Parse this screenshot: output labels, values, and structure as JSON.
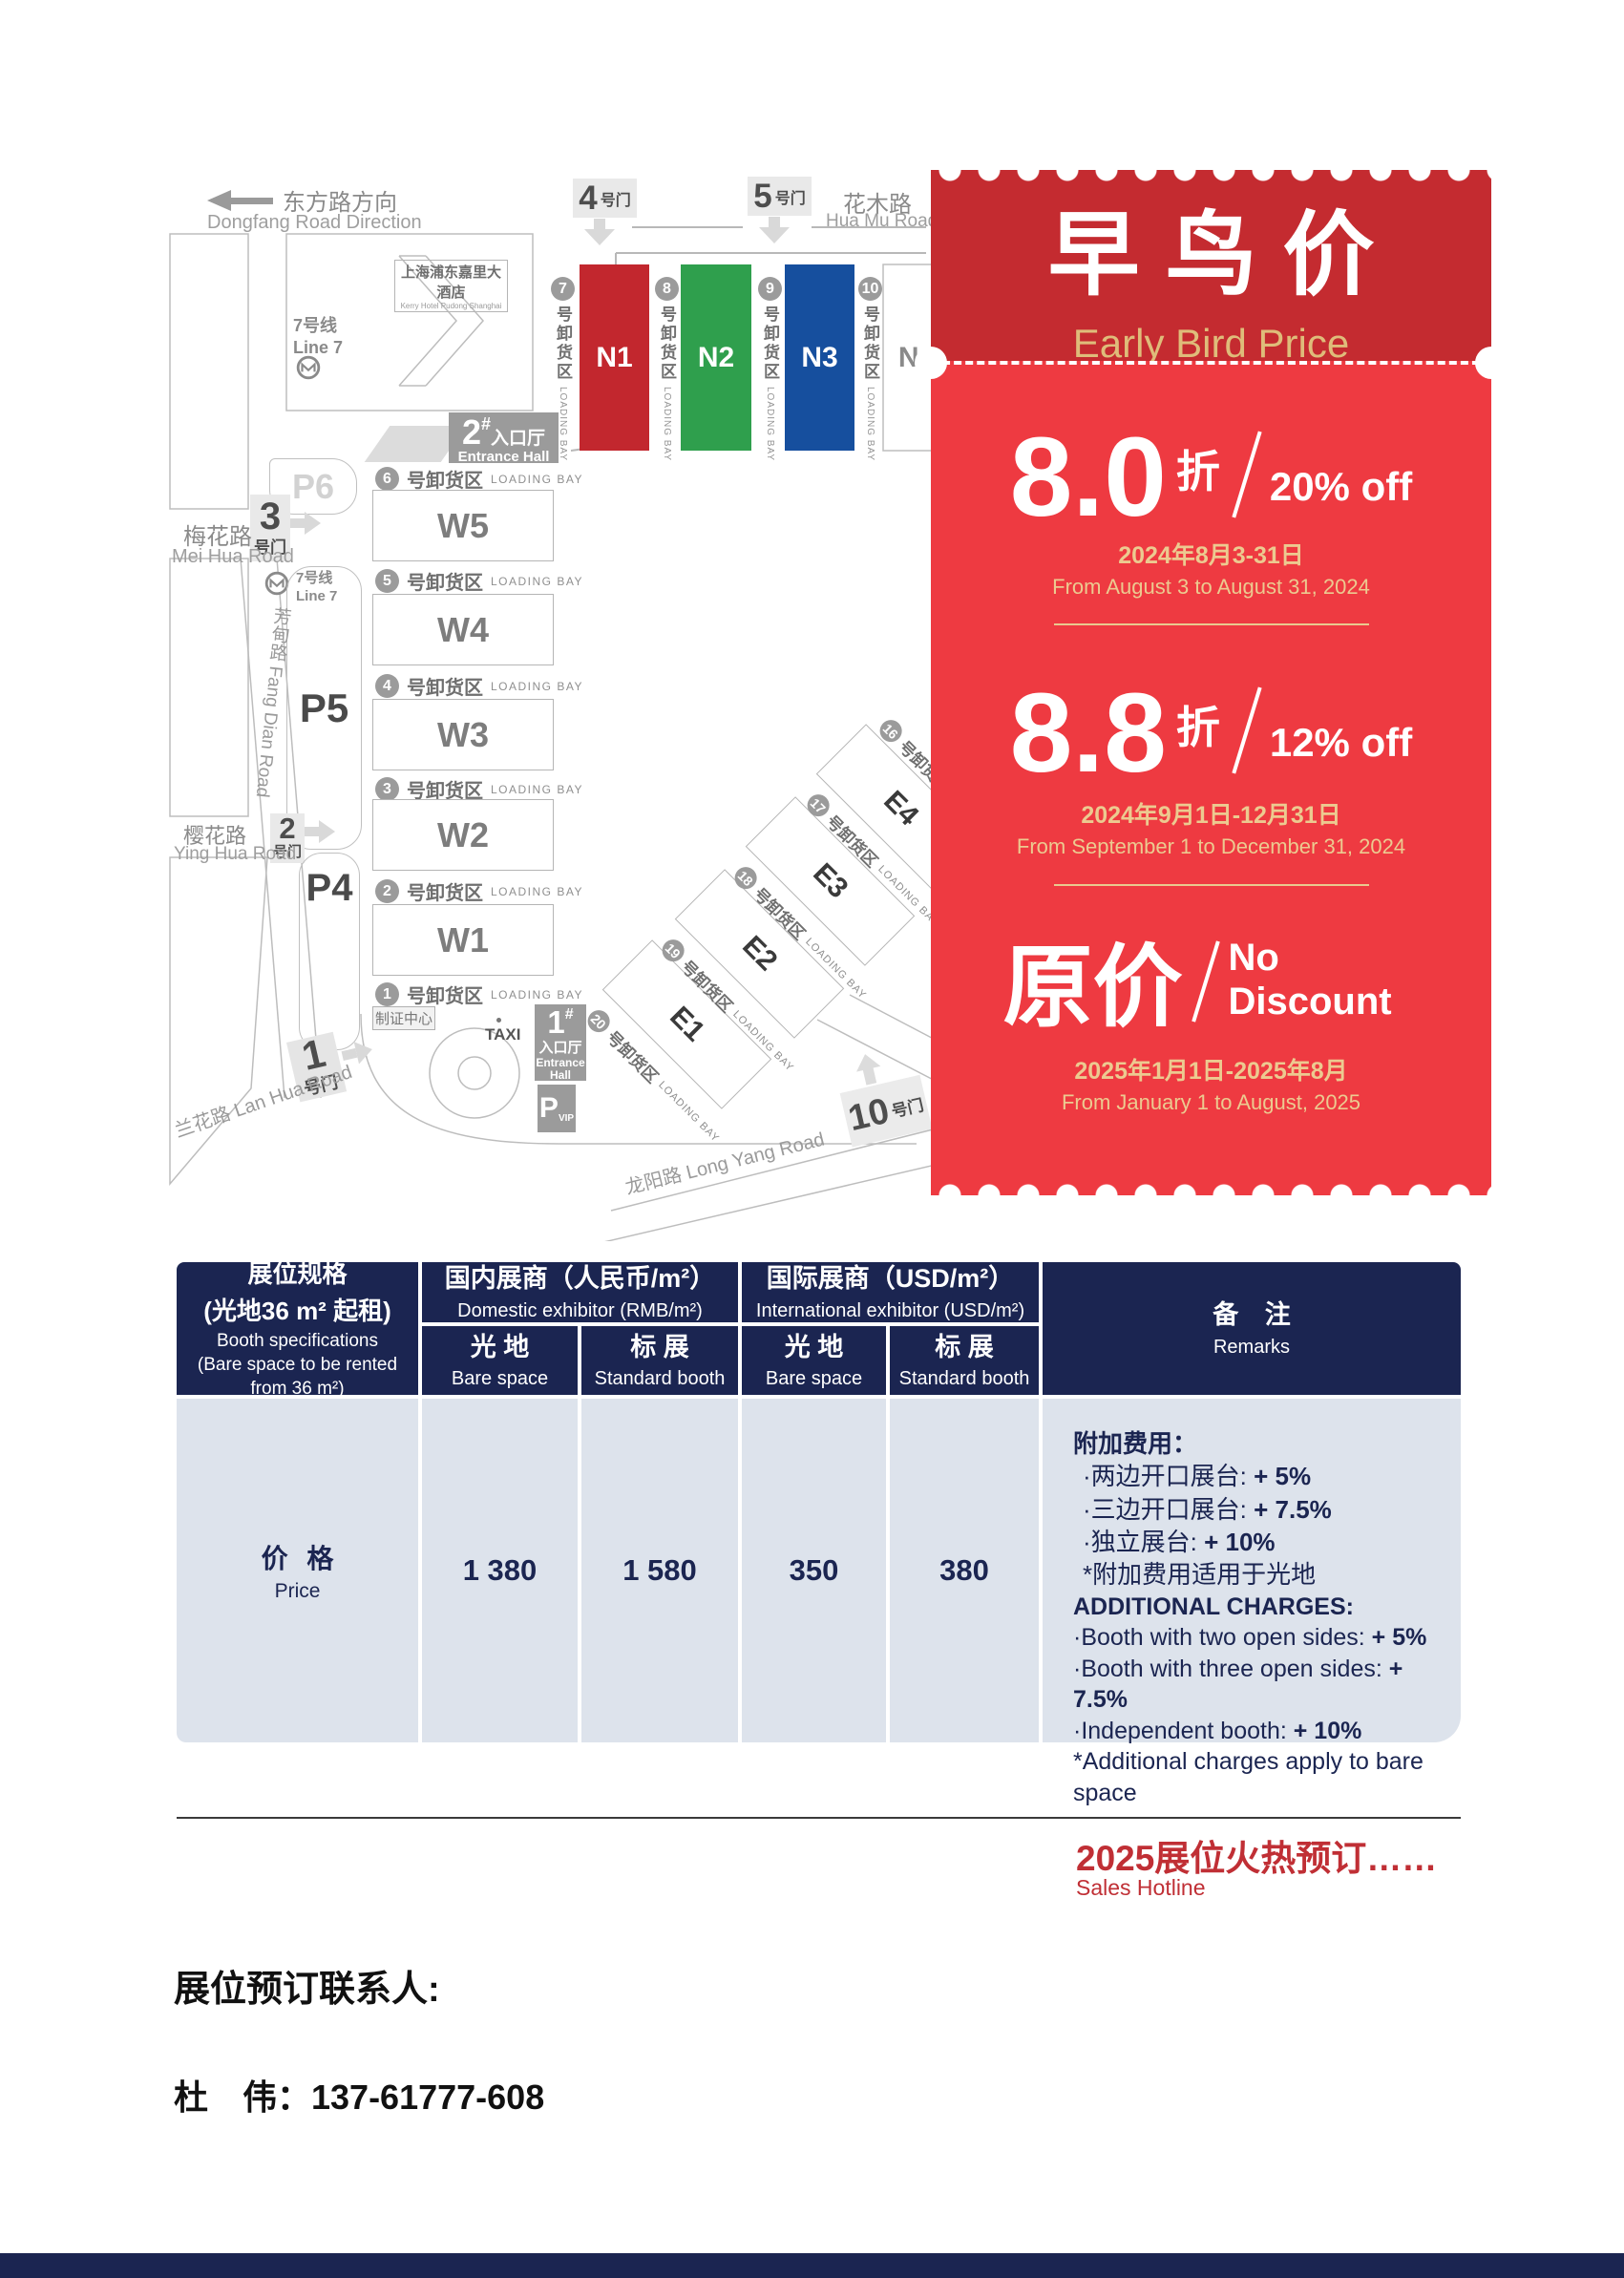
{
  "map": {
    "direction": {
      "zh": "东方路方向",
      "en": "Dongfang Road Direction"
    },
    "hua_mu": {
      "zh": "花木路",
      "en": "Hua Mu Road"
    },
    "mei_hua": {
      "zh": "梅花路",
      "en": "Mei Hua Road"
    },
    "ying_hua": {
      "zh": "樱花路",
      "en": "Ying Hua Road"
    },
    "fang_dian": {
      "label": "芳甸路 Fang Dian Road"
    },
    "lan_hua": {
      "label": "兰花路 Lan Hua Road"
    },
    "long_yang": {
      "label": "龙阳路 Long Yang Road"
    },
    "hotel": {
      "zh": "上海浦东嘉里大酒店",
      "en": "Kerry Hotel Pudong Shanghai"
    },
    "metro": {
      "zh": "7号线",
      "en": "Line 7"
    },
    "gates": {
      "g4": "4",
      "g5": "5",
      "g3": "3",
      "g2": "2",
      "g1": "1",
      "g10": "10",
      "suffix": "号门"
    },
    "entrance2": {
      "num": "2",
      "hash": "#",
      "zh": "入口厅",
      "en": "Entrance Hall"
    },
    "entrance1": {
      "num": "1",
      "hash": "#",
      "zh": "入口厅",
      "en1": "Entrance",
      "en2": "Hall"
    },
    "parking": {
      "p6": "P6",
      "p5": "P5",
      "p4": "P4",
      "pvip_p": "P",
      "pvip_sub": "VIP"
    },
    "taxi": "TAXI",
    "badge_center": "制证中心",
    "loading_bay": {
      "zh": "号卸货区",
      "en": "LOADING BAY"
    },
    "n_halls": [
      {
        "name": "N1",
        "color": "#c2272e"
      },
      {
        "name": "N2",
        "color": "#2f9f4d"
      },
      {
        "name": "N3",
        "color": "#164f9e"
      },
      {
        "name": "N4",
        "color": "#ffffff"
      }
    ],
    "n_bays": [
      "7",
      "8",
      "9",
      "10"
    ],
    "w_halls": [
      "W5",
      "W4",
      "W3",
      "W2",
      "W1"
    ],
    "w_bays": [
      "6",
      "5",
      "4",
      "3",
      "2",
      "1"
    ],
    "e_halls": [
      "E4",
      "E3",
      "E2",
      "E1"
    ],
    "e_bays": [
      "16",
      "17",
      "18",
      "19",
      "20"
    ]
  },
  "ticket": {
    "bg_top": "#c42b30",
    "bg_bottom": "#ee3a41",
    "gold": "#ecca90",
    "title_zh": "早鸟价",
    "title_en": "Early Bird Price",
    "tier1": {
      "big": "8.0",
      "unit": "折",
      "off": "20% off",
      "date_zh": "2024年8月3-31日",
      "date_en": "From August 3 to August 31, 2024"
    },
    "tier2": {
      "big": "8.8",
      "unit": "折",
      "off": "12% off",
      "date_zh": "2024年9月1日-12月31日",
      "date_en": "From September 1 to December 31, 2024"
    },
    "tier3": {
      "big": "原价",
      "off": "No Discount",
      "date_zh": "2025年1月1日-2025年8月",
      "date_en": "From January 1 to August, 2025"
    }
  },
  "table": {
    "header_bg": "#1b2551",
    "body_bg": "#dde3ec",
    "spec": {
      "zh1": "展位规格",
      "zh2": "(光地36 m² 起租)",
      "en1": "Booth specifications",
      "en2": "(Bare space to be rented",
      "en3": "from 36 m²)"
    },
    "domestic": {
      "zh": "国内展商（人民币/m²）",
      "en": "Domestic exhibitor (RMB/m²)"
    },
    "international": {
      "zh": "国际展商（USD/m²）",
      "en": "International exhibitor (USD/m²)"
    },
    "bare": {
      "zh": "光 地",
      "en": "Bare space"
    },
    "standard": {
      "zh": "标 展",
      "en": "Standard booth"
    },
    "remarks": {
      "zh": "备 注",
      "en": "Remarks"
    },
    "price_label": {
      "zh": "价 格",
      "en": "Price"
    },
    "values": [
      "1 380",
      "1 580",
      "350",
      "380"
    ],
    "remarks_zh": {
      "head": "附加费用：",
      "i1t": "·两边开口展台: ",
      "i1v": "+ 5%",
      "i2t": "·三边开口展台: ",
      "i2v": "+ 7.5%",
      "i3t": "·独立展台: ",
      "i3v": "+ 10%",
      "note": "*附加费用适用于光地"
    },
    "remarks_en": {
      "head": "ADDITIONAL CHARGES:",
      "i1t": "·Booth with two open sides: ",
      "i1v": "+ 5%",
      "i2t": "·Booth with three open sides: ",
      "i2v": "+ 7.5%",
      "i3t": "·Independent booth: ",
      "i3v": "+ 10%",
      "note": "*Additional charges apply to bare space"
    }
  },
  "footer": {
    "hotline_zh": "2025展位火热预订……",
    "hotline_en": "Sales Hotline",
    "contact_label": "展位预订联系人:",
    "contact_name": "杜　伟：137-61777-608",
    "accent": "#c02f35",
    "bar": "#1b2551"
  }
}
